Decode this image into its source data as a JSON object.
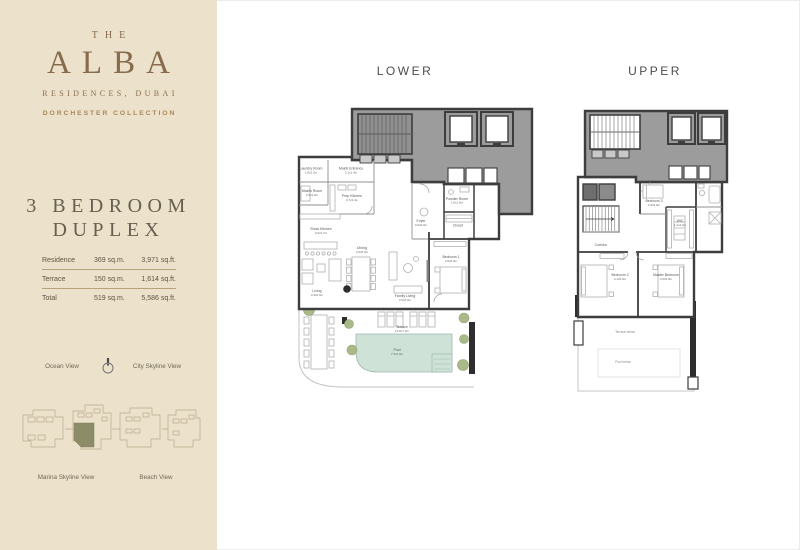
{
  "sidebar": {
    "brand": {
      "pre": "THE",
      "name": "ALBA",
      "sub": "RESIDENCES, DUBAI",
      "collection": "DORCHESTER COLLECTION"
    },
    "unit": {
      "title_line1": "3 BEDROOM",
      "title_line2": "DUPLEX"
    },
    "area_table": {
      "rows": [
        {
          "label": "Residence",
          "sqm": "369 sq.m.",
          "sqft": "3,971 sq.ft."
        },
        {
          "label": "Terrace",
          "sqm": "150 sq.m.",
          "sqft": "1,614 sq.ft."
        },
        {
          "label": "Total",
          "sqm": "519 sq.m.",
          "sqft": "5,586 sq.ft."
        }
      ]
    },
    "orientation": {
      "left": "Ocean View",
      "right": "City Skyline View"
    },
    "siteplan_labels": {
      "left": "Marina Skyline View",
      "right": "Beach View"
    }
  },
  "plans": {
    "lower": {
      "title": "LOWER",
      "rooms": [
        {
          "name": "Laundry Room",
          "dims": "1.8x2.2m"
        },
        {
          "name": "Maids Entrance",
          "dims": "2.1x1.3m"
        },
        {
          "name": "Maid's Room",
          "dims": "2.5x2.9m"
        },
        {
          "name": "Prep Kitchen",
          "dims": "3.7x3.4m"
        },
        {
          "name": "Show Kitchen",
          "dims": "3.6x4.7m"
        },
        {
          "name": "Living",
          "dims": "4.4x6.0m"
        },
        {
          "name": "Dining",
          "dims": "4.0x5.0m"
        },
        {
          "name": "Foyer",
          "dims": "3.0x6.0m"
        },
        {
          "name": "Family Living",
          "dims": "4.5x6.0m"
        },
        {
          "name": "Bedroom 1",
          "dims": "4.0x5.0m"
        },
        {
          "name": "Powder Room",
          "dims": "1.6x1.6m"
        },
        {
          "name": "Closet",
          "dims": ""
        },
        {
          "name": "Terrace",
          "dims": "13.8x7.3m"
        },
        {
          "name": "Pool",
          "dims": "7.5x2.9m"
        }
      ]
    },
    "upper": {
      "title": "UPPER",
      "rooms": [
        {
          "name": "Bedroom 3",
          "dims": "2.9x5.0m"
        },
        {
          "name": "WIC",
          "dims": "1.2x4.2m"
        },
        {
          "name": "Corridor",
          "dims": ""
        },
        {
          "name": "Bedroom 2",
          "dims": "4.1x5.0m"
        },
        {
          "name": "Master Bedroom",
          "dims": "4.5x5.0m"
        },
        {
          "name": "Terrace below",
          "dims": ""
        },
        {
          "name": "Pool below",
          "dims": ""
        }
      ]
    }
  },
  "colors": {
    "sidebar_bg": "#ece2cb",
    "brand_brown": "#876b4d",
    "collection_gold": "#a8885c",
    "unit_title": "#675f4f",
    "wall_dark": "#3d3d3d",
    "core_gray": "#9c9c9c",
    "pool_teal": "#cfe2d8",
    "tree_green": "#a9b98a",
    "site_highlight": "#8d8c68"
  }
}
